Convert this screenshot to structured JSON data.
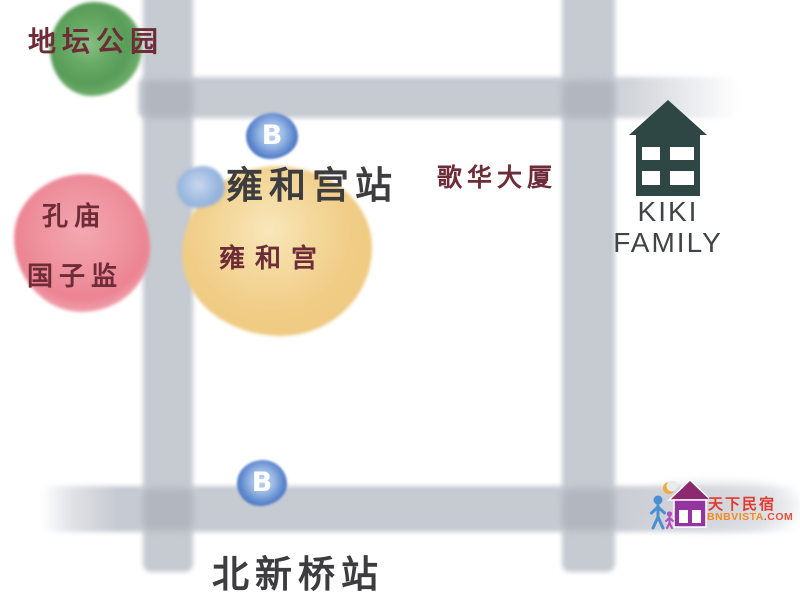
{
  "map": {
    "background_color": "#ffffff",
    "road_color": "#c6cad1",
    "road_intersection_color": "#aeb3bc",
    "place_label_color": "#6e2c38",
    "station_label_color": "#3d3d40",
    "places": {
      "ditan_park": {
        "label": "地坛公园",
        "blob_color": "#67aa64"
      },
      "confucius_temple": {
        "label": "孔庙"
      },
      "guozijian": {
        "label": "国子监",
        "blob_color": "#ec8493"
      },
      "yonghegong_station": {
        "label": "雍和宫站"
      },
      "yonghegong_temple": {
        "label": "雍和宫",
        "blob_color": "#f0cc85"
      },
      "gehua_building": {
        "label": "歌华大厦"
      },
      "beixinqiao_station": {
        "label": "北新桥站"
      }
    },
    "subway_marker": {
      "letter": "B",
      "color": "#3f6cba"
    },
    "property": {
      "name_line1": "KIKI",
      "name_line2": "FAMILY",
      "house_color": "#2e4644",
      "text_color": "#3f4447"
    },
    "watermark": {
      "brand": "天下民宿",
      "brand_color": "#e03a31",
      "site": "BNBVISTA",
      "site_color": "#f58a1f",
      "tld": ".COM",
      "tld_color": "#e94e3f"
    }
  }
}
